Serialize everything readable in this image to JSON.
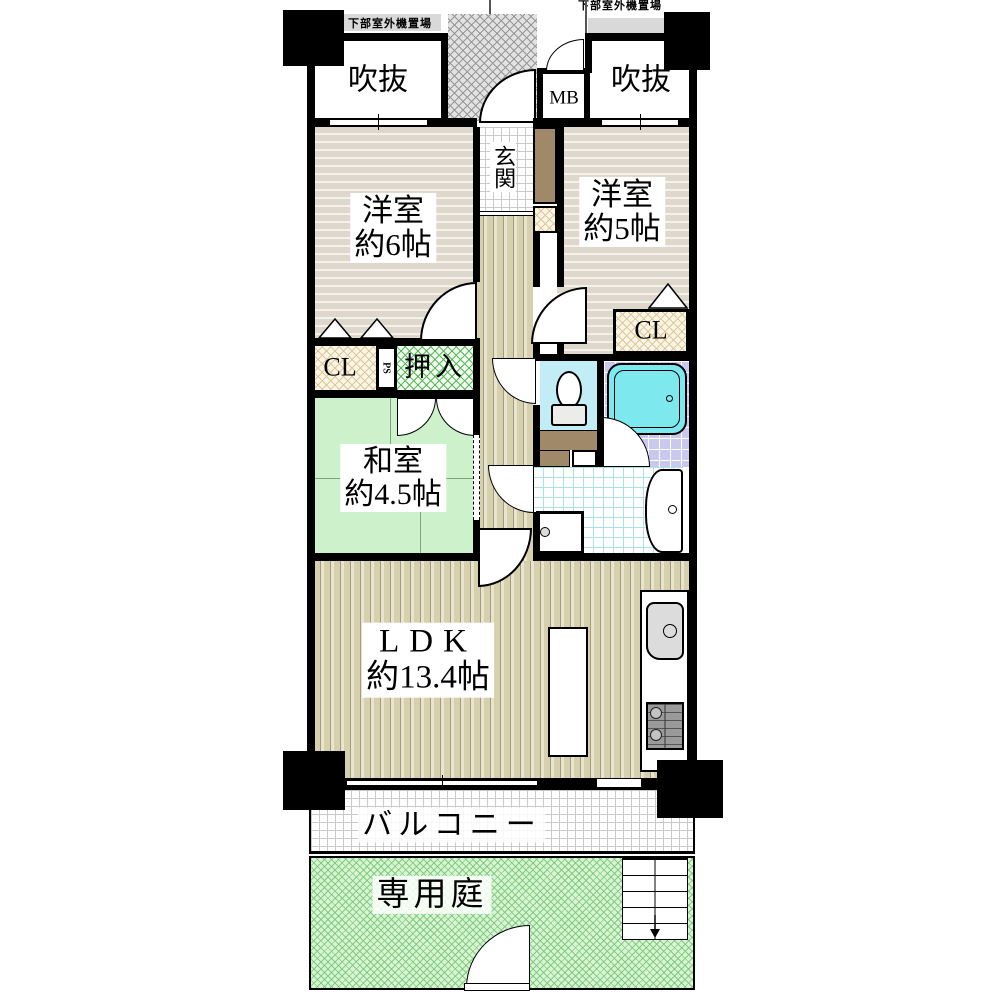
{
  "plan": {
    "title": "apartment-floor-plan",
    "annotations": {
      "outdoor_unit_left": "下部室外機置場",
      "outdoor_unit_right": "下部室外機置場"
    },
    "rooms": {
      "void_left": {
        "name": "吹抜"
      },
      "void_right": {
        "name": "吹抜"
      },
      "meter_box": {
        "name": "MB"
      },
      "entrance": {
        "name": "玄関"
      },
      "western_room_6": {
        "name": "洋室",
        "size": "約6帖"
      },
      "western_room_5": {
        "name": "洋室",
        "size": "約5帖"
      },
      "closet_left": {
        "name": "CL"
      },
      "closet_right": {
        "name": "CL"
      },
      "pipe_space": {
        "name": "PS"
      },
      "oshiire": {
        "name": "押入"
      },
      "japanese_room": {
        "name": "和室",
        "size": "約4.5帖"
      },
      "ldk": {
        "name": "LDK",
        "size": "約13.4帖"
      },
      "balcony": {
        "name": "バルコニー"
      },
      "garden": {
        "name": "専用庭"
      }
    },
    "colors": {
      "wall": "#000000",
      "wood_floor": "#d7d0ae",
      "western_floor": "#ddd7cc",
      "tatami": "#cdf2cb",
      "toilet_floor": "#c2ecf6",
      "bath_tile": "#c9c9f0",
      "bathtub": "#7de9ef",
      "garden": "#d9f3d4",
      "cabinet_brown": "#a08968",
      "outdoor_strip": "#d9d9d9"
    }
  }
}
